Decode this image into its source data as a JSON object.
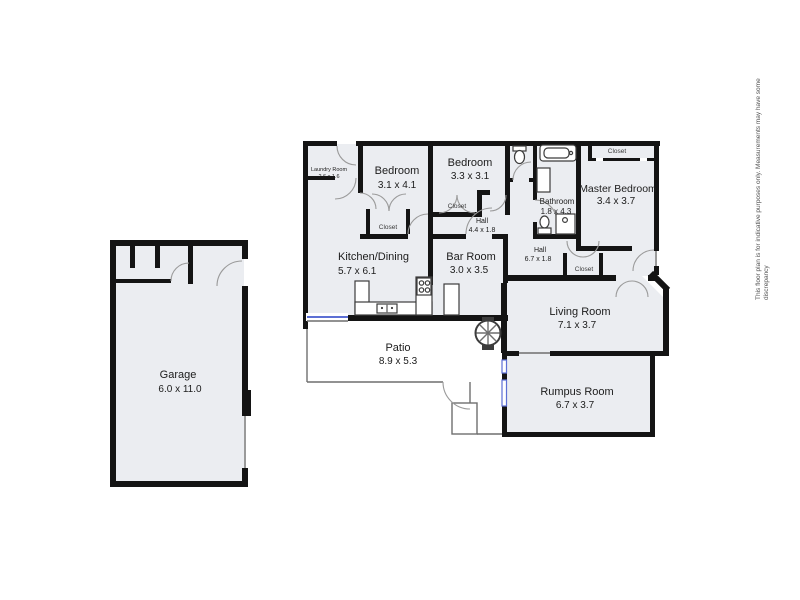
{
  "page": {
    "background": "#ffffff"
  },
  "floorplan": {
    "colors": {
      "wall": "#141414",
      "floor": "#ebedf1",
      "window": "#5c6fd4",
      "door_arc": "#9a9a9a",
      "fixture": "#3c3c3c",
      "label": "#1c1c1c"
    },
    "rooms": {
      "garage": {
        "name": "Garage",
        "dims": "6.0 x 11.0"
      },
      "laundry": {
        "name": "Laundry Room",
        "dims": "2.6 x 1.6"
      },
      "bedroom1": {
        "name": "Bedroom",
        "dims": "3.1 x 4.1"
      },
      "bedroom2": {
        "name": "Bedroom",
        "dims": "3.3 x 3.1"
      },
      "hall1": {
        "name": "Hall",
        "dims": "4.4 x 1.8"
      },
      "bathroom": {
        "name": "Bathroom",
        "dims": "1.8 x 4.3"
      },
      "master": {
        "name": "Master Bedroom",
        "dims": "3.4 x 3.7"
      },
      "hall2": {
        "name": "Hall",
        "dims": "6.7 x 1.8"
      },
      "kitchen": {
        "name": "Kitchen/Dining",
        "dims": "5.7 x 6.1"
      },
      "bar": {
        "name": "Bar Room",
        "dims": "3.0 x 3.5"
      },
      "living": {
        "name": "Living Room",
        "dims": "7.1 x 3.7"
      },
      "patio": {
        "name": "Patio",
        "dims": "8.9 x 5.3"
      },
      "rumpus": {
        "name": "Rumpus Room",
        "dims": "6.7 x 3.7"
      }
    },
    "labels": {
      "closet": "Closet"
    },
    "disclaimer": {
      "line1": "This floor plan is for indicative purposes only. Measurements may have some",
      "line2": "discrepancy"
    }
  }
}
